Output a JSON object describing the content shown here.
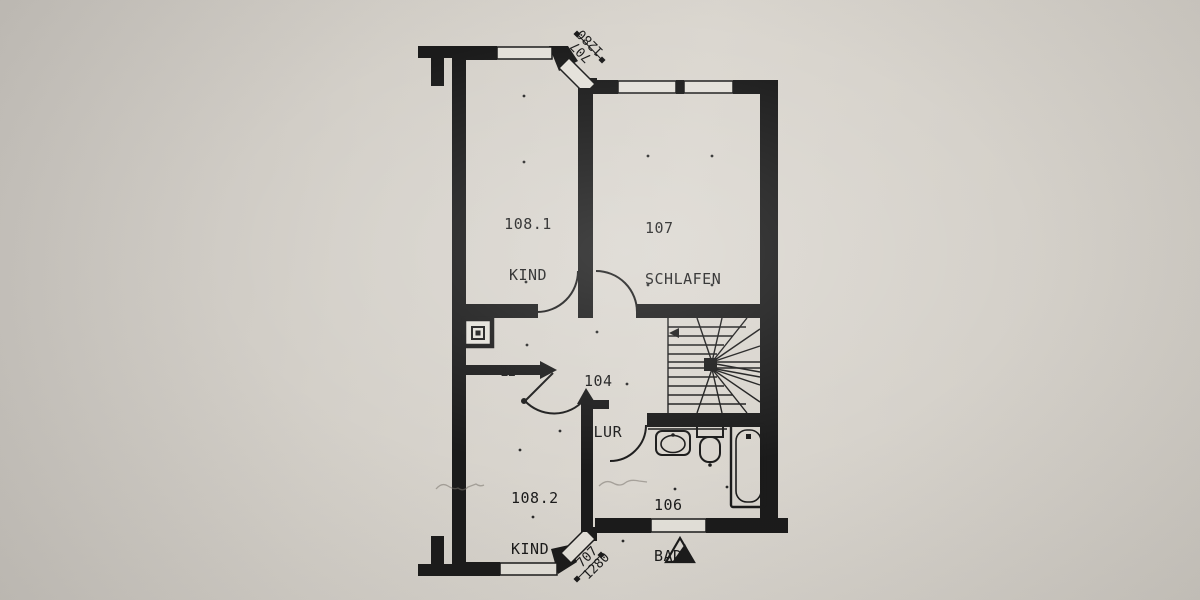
{
  "floorplan": {
    "rooms": [
      {
        "number": "108.1",
        "name": "KIND"
      },
      {
        "number": "107",
        "name": "SCHLAFEN"
      },
      {
        "number": "104",
        "name": "FLUR"
      },
      {
        "number": "108.2",
        "name": "KIND"
      },
      {
        "number": "106",
        "name": "BAD"
      }
    ],
    "shaft": {
      "label": "12"
    },
    "dimensions": {
      "top": {
        "line1": "707",
        "line2": "1280"
      },
      "bottom": {
        "line1": "707",
        "line2": "1280"
      }
    },
    "colors": {
      "paper": "#d6d2ca",
      "ink": "#1b1b1b"
    },
    "symbols": [
      "staircase",
      "stair-direction-arrow",
      "bathtub",
      "toilet",
      "washbasin",
      "shaft-symbol",
      "entrance-triangle",
      "window",
      "door-swing"
    ]
  }
}
